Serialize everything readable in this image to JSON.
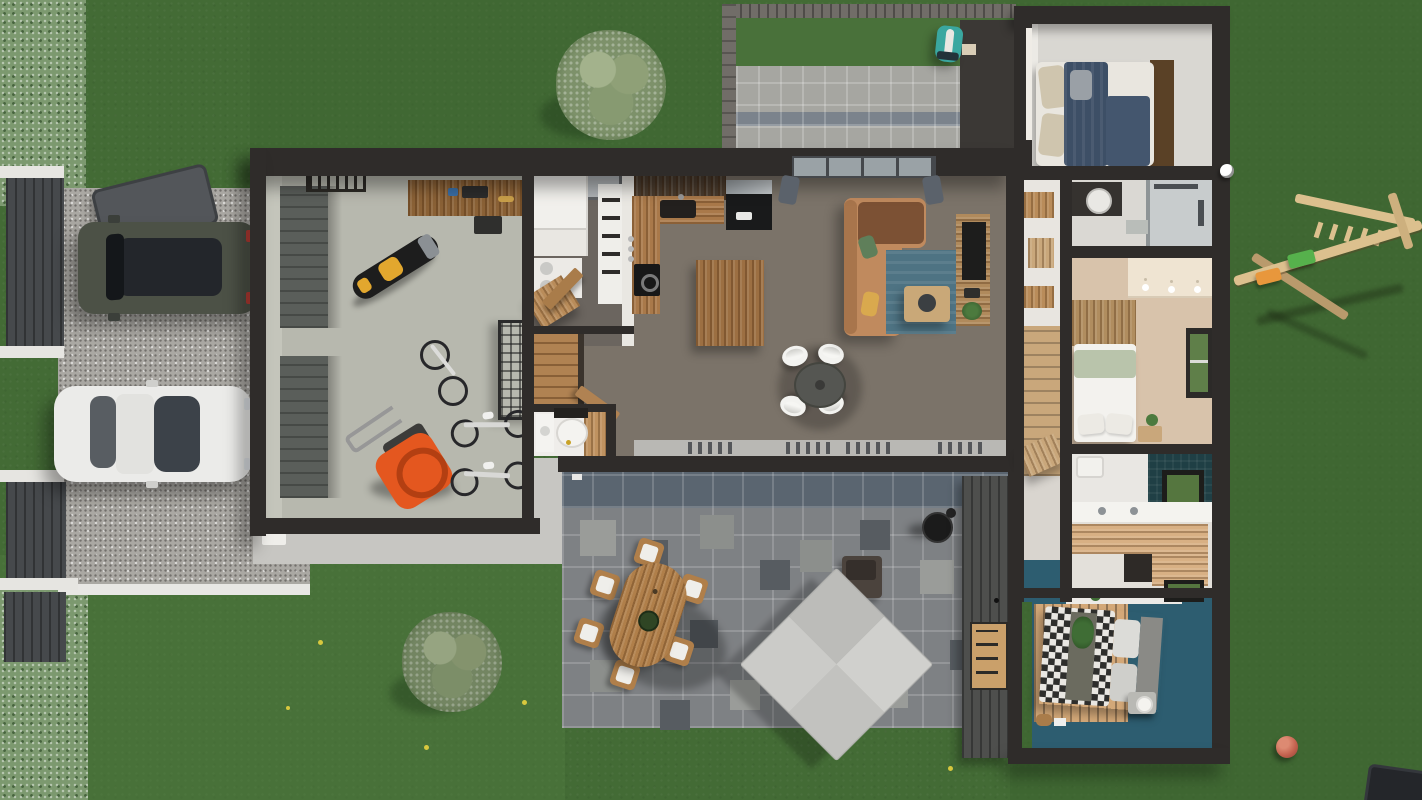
{
  "scene": {
    "type": "3d-floor-plan-top-view",
    "description": "Photorealistic top-down 3D rendering of a single-storey house: lawn and hedge, gravel driveway with two parked cars and gates, double garage with motorcycle, bicycles and lawn mower, pantry-laundry, open-plan kitchen-dining-living room, entry with stairs and WC, hallway wing with three bedrooms and two bathrooms, north pergola patio with robot mower, south paver terrace with wooden dining set, cantilever parasol and barbecue, wooden climbing frame and balls on the lawn."
  },
  "palette": {
    "grass": "#436b35",
    "grassDark": "#3c6530",
    "grassLight": "#4f7a3d",
    "hedge": "#7c996f",
    "gravel": "#aaa8a3",
    "curb": "#e8e7e4",
    "wall": "#2f2c2a",
    "frame": "#716d68",
    "garageFloor": "#b7b8ae",
    "garageDoor": "#5a5e5a",
    "mudFloor": "#6b655f",
    "floor": "#7b7369",
    "wood": "#a9794a",
    "woodLight": "#c9a77b",
    "woodDark": "#4a3b2d",
    "woodPale": "#dcc08e",
    "island": "#9c6f42",
    "white": "#f1f0ec",
    "fridge": "#191a1b",
    "sofa": "#c08a5e",
    "sofaDark": "#7c5134",
    "rug": "#4e7383",
    "pillowGreen": "#5f7f5a",
    "pillowYellow": "#d9a94e",
    "tableDark": "#555652",
    "tvWood": "#b08a5c",
    "bedNavy": "#3d4f66",
    "bedBeige": "#cfc5ae",
    "headboard": "#5a4126",
    "masterFloor": "#d8c3ab",
    "wardrobe": "#efe4d2",
    "sage": "#b9c4ab",
    "bathFloor": "#dad8d3",
    "tealDark": "#1f3f45",
    "tealKid": "#2d5d70",
    "kidWood": "#d3a878",
    "checkerDark": "#2e2e2c",
    "paver": "#7e8184",
    "paverDark": "#575c61",
    "paverLight": "#9a9c99",
    "paverBlue": "#5a6570",
    "topPaver": "#a6a6a1",
    "canopy": "#cbcbc8",
    "teak": "#b07f4a",
    "suv": "#4c5146",
    "glass": "#23262b",
    "sedan": "#ebebe9",
    "swing": "#dcc08e",
    "seatGreen": "#56b14c",
    "seatOrange": "#e8973c",
    "ballRed": "#c2604d",
    "mower": "#e4571f",
    "moto": "#e2a72e",
    "annex": "#4e4f4d",
    "robot": "#3aa7a0"
  },
  "areas": {
    "garden": {
      "label": "Lawn and garden",
      "objects": [
        "boundary hedge",
        "round tree",
        "shrub",
        "yellow flowers",
        "wooden climbing frame with green and orange swings",
        "soccer ball",
        "red ball",
        "robot lawn mower",
        "dark corner object"
      ]
    },
    "driveway": {
      "label": "Gravel driveway",
      "objects": [
        "north gate",
        "south gate",
        "wheelie bin",
        "dark green SUV",
        "white sedan",
        "white curb",
        "doorstep"
      ]
    },
    "garage": {
      "label": "Garage",
      "objects": [
        "two sectional doors",
        "wall ladder",
        "workbench",
        "yellow-black motorcycle",
        "bicycle on floor",
        "wire storage rack",
        "orange lawn mower",
        "two stationary bikes"
      ]
    },
    "utility": {
      "label": "Pantry / laundry",
      "objects": [
        "white cabinets",
        "appliance stack",
        "rooflight",
        "tall shelf",
        "open wood door",
        "angled desk"
      ]
    },
    "kitchen": {
      "label": "Kitchen",
      "objects": [
        "L-shaped wood counter",
        "sink",
        "black cooktop",
        "black fridge",
        "wood island",
        "spice jars"
      ]
    },
    "living": {
      "label": "Living / dining room",
      "objects": [
        "tan L-sofa with green and yellow pillows",
        "teal rug",
        "wood coffee table",
        "round dining table",
        "4 white chairs",
        "TV sideboard with plant",
        "window with curtains",
        "sliding glass doors"
      ]
    },
    "entry": {
      "label": "Entry",
      "objects": [
        "wood staircase",
        "open door",
        "WC with toilet and vanity"
      ]
    },
    "hallway": {
      "label": "Hallway",
      "objects": [
        "wood closet niches",
        "wood floor section",
        "teal accent",
        "small desk"
      ]
    },
    "bedroom_north": {
      "label": "Bedroom north",
      "objects": [
        "double bed with navy duvet and beige pillows",
        "dark wood headboard"
      ]
    },
    "bathroom_north": {
      "label": "Bathroom north",
      "objects": [
        "dark vanity with round sink",
        "glass shower",
        "bath mat"
      ]
    },
    "master_bedroom": {
      "label": "Master bedroom",
      "objects": [
        "cream wardrobe with pendant lights",
        "wood panel headboard wall",
        "white bed with sage throw",
        "bedside table with plant",
        "garden window"
      ]
    },
    "bathroom_south": {
      "label": "Bathroom south",
      "objects": [
        "teal tiled wall",
        "toilet",
        "white counter with sink",
        "garden window",
        "wood laundry counter"
      ]
    },
    "kids_bedroom": {
      "label": "Kids bedroom",
      "objects": [
        "teal floor",
        "wood rug",
        "bed with black-white checkered blanket",
        "grey headboard",
        "nightstand with lamp",
        "desk with plant",
        "toys"
      ]
    },
    "north_patio": {
      "label": "North patio",
      "objects": [
        "pergola beams",
        "grass strip",
        "light pavers with blue band",
        "robot mower dock"
      ]
    },
    "south_patio": {
      "label": "South terrace",
      "objects": [
        "grey paver field",
        "teak oval table",
        "6 wooden chairs with white cushions",
        "fruit bowl",
        "cantilever parasol with base",
        "kettle barbecue",
        "dark wood annex wall with door"
      ]
    },
    "counts": {
      "interior_chairs": 4,
      "outdoor_chairs": 6,
      "cars": 2,
      "bedrooms": 3,
      "bathrooms": 2
    }
  }
}
